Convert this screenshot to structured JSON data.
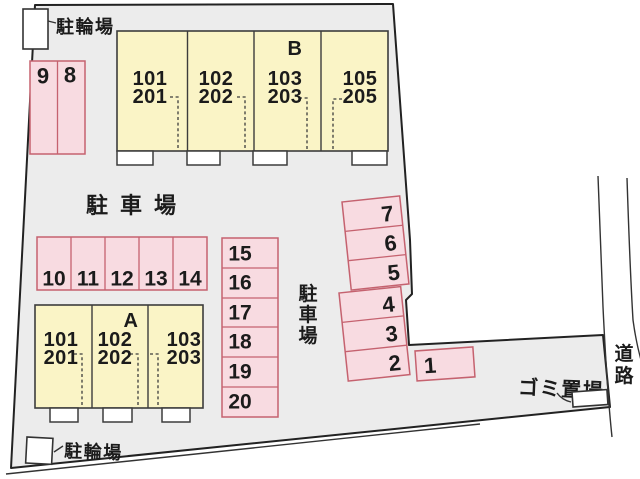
{
  "labels": {
    "bicycle_parking_top": "駐輪場",
    "bicycle_parking_bottom": "駐輪場",
    "parking_lot": "駐車場",
    "parking_lot_vertical": "駐車場",
    "garbage_area": "ゴミ置場",
    "road": "道路"
  },
  "buildings": {
    "b": {
      "name": "B",
      "units": [
        {
          "upper": "101",
          "lower": "201"
        },
        {
          "upper": "102",
          "lower": "202"
        },
        {
          "upper": "103",
          "lower": "203"
        },
        {
          "upper": "105",
          "lower": "205"
        }
      ]
    },
    "a": {
      "name": "A",
      "units": [
        {
          "upper": "101",
          "lower": "201"
        },
        {
          "upper": "102",
          "lower": "202"
        },
        {
          "upper": "103",
          "lower": "203"
        }
      ]
    }
  },
  "parking": {
    "pair_top_left": [
      "9",
      "8"
    ],
    "middle_row": [
      "10",
      "11",
      "12",
      "13",
      "14"
    ],
    "middle_column": [
      "15",
      "16",
      "17",
      "18",
      "19",
      "20"
    ],
    "right_upper": [
      "7",
      "6",
      "5"
    ],
    "right_lower": [
      "4",
      "3",
      "2"
    ],
    "right_single": "1"
  },
  "colors": {
    "site_fill": "#ececec",
    "boundary": "#222222",
    "parking_fill": "#f8dbe1",
    "parking_stroke": "#c5626f",
    "building_fill": "#faf4c6",
    "building_stroke": "#3c3c3c",
    "structure_fill": "#ffffff"
  }
}
